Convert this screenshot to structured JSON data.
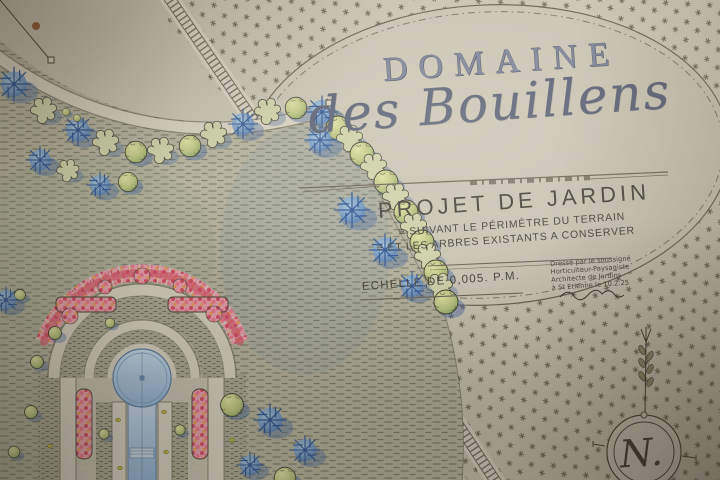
{
  "plan": {
    "estate_title": "DOMAINE",
    "estate_name": "des Bouillens",
    "project_title": "PROJET DE JARDIN",
    "note_marker": "≡",
    "project_note_line1": "SUIVANT LE PÉRIMÈTRE DU TERRAIN",
    "project_note_line2": "ET LES ARBRES EXISTANTS A CONSERVER",
    "scale_note": "ECHELLE DE 0,005. P.M.",
    "credit_line1": "Dressé par le soussigné",
    "credit_line2": "Horticulteur-Paysagiste",
    "credit_line3": "Architecte de Jardins",
    "credit_line4": "à St Etienne le 10.2.25",
    "compass_letter": "N."
  },
  "colors": {
    "paper": "#c9c3b4",
    "paper_light": "#d6d0c1",
    "ink": "#4a4538",
    "ink_soft": "#6a6456",
    "title_blue": "#7a8196",
    "script_blue": "#565d72",
    "water": "#a9c3da",
    "water_deep": "#8fb0cf",
    "foliage_green": "#b8c27f",
    "foliage_dark": "#7f9a5e",
    "tree_blue": "#6d95c2",
    "tree_blue_dark": "#2f5590",
    "shadow_blue": "#49699c",
    "flower_pink": "#e8798f",
    "flower_red": "#d34f63",
    "flower_orange": "#e59a56",
    "stain_rust": "#8a4420"
  }
}
